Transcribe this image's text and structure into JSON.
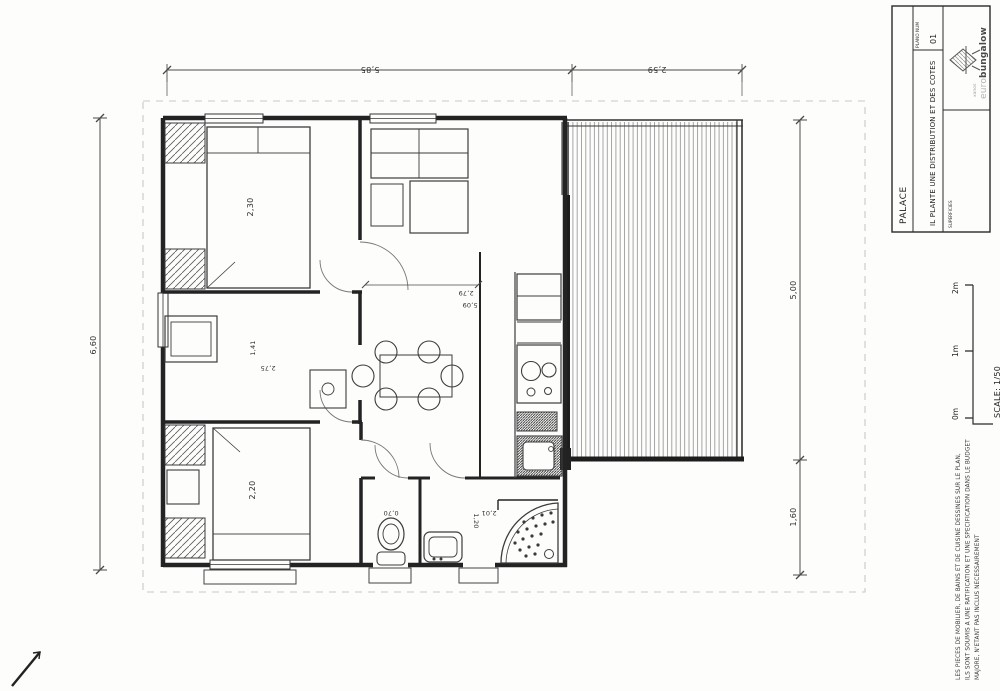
{
  "title_block": {
    "project": "PALACE",
    "plan_num_label": "PLANO NUM",
    "plan_num": "01",
    "drawing_title": "IL PLANTE UNE DISTRIBUTION ET DES COTES",
    "section_label": "SUPERFICIES",
    "logo": {
      "tagline": "xanos",
      "brand_light": "euro",
      "brand_bold": "bungalow"
    }
  },
  "scale_bar": {
    "ticks": [
      "0m",
      "1m",
      "2m"
    ],
    "scale_label": "SCALE: 1/50"
  },
  "disclaimer": {
    "lines": [
      "LES PIECES DE MOBILIER, DE BAINS ET DE CUISINE DESSINES SUR LE PLAN,",
      "ILS SONT SOUMIS A UNE RATIFICATION ET UNE SPECIFICATION DANS LE BUDGET",
      "MAJORE, N'ETANT PAS INCLUS NECESSAIREMENT"
    ]
  },
  "dimensions": {
    "top": [
      "5,85",
      "2,59"
    ],
    "left": [
      "6,60"
    ],
    "right": [
      "5,00",
      "1,60"
    ],
    "interior": {
      "bedroom1": "2,30",
      "bedroom2_a": "1,41",
      "bedroom2_b": "2,75",
      "bedroom3": "2,20",
      "hall_a": "2,79",
      "hall_b": "5,09",
      "wc": "0,70",
      "bath_a": "1,20",
      "bath_b": "2,01"
    }
  },
  "colors": {
    "wall": "#262626",
    "line": "#444444",
    "frame_dash": "#c9c9c9",
    "paper": "#fdfdfc",
    "deck_plank": "#8f8f8f"
  }
}
